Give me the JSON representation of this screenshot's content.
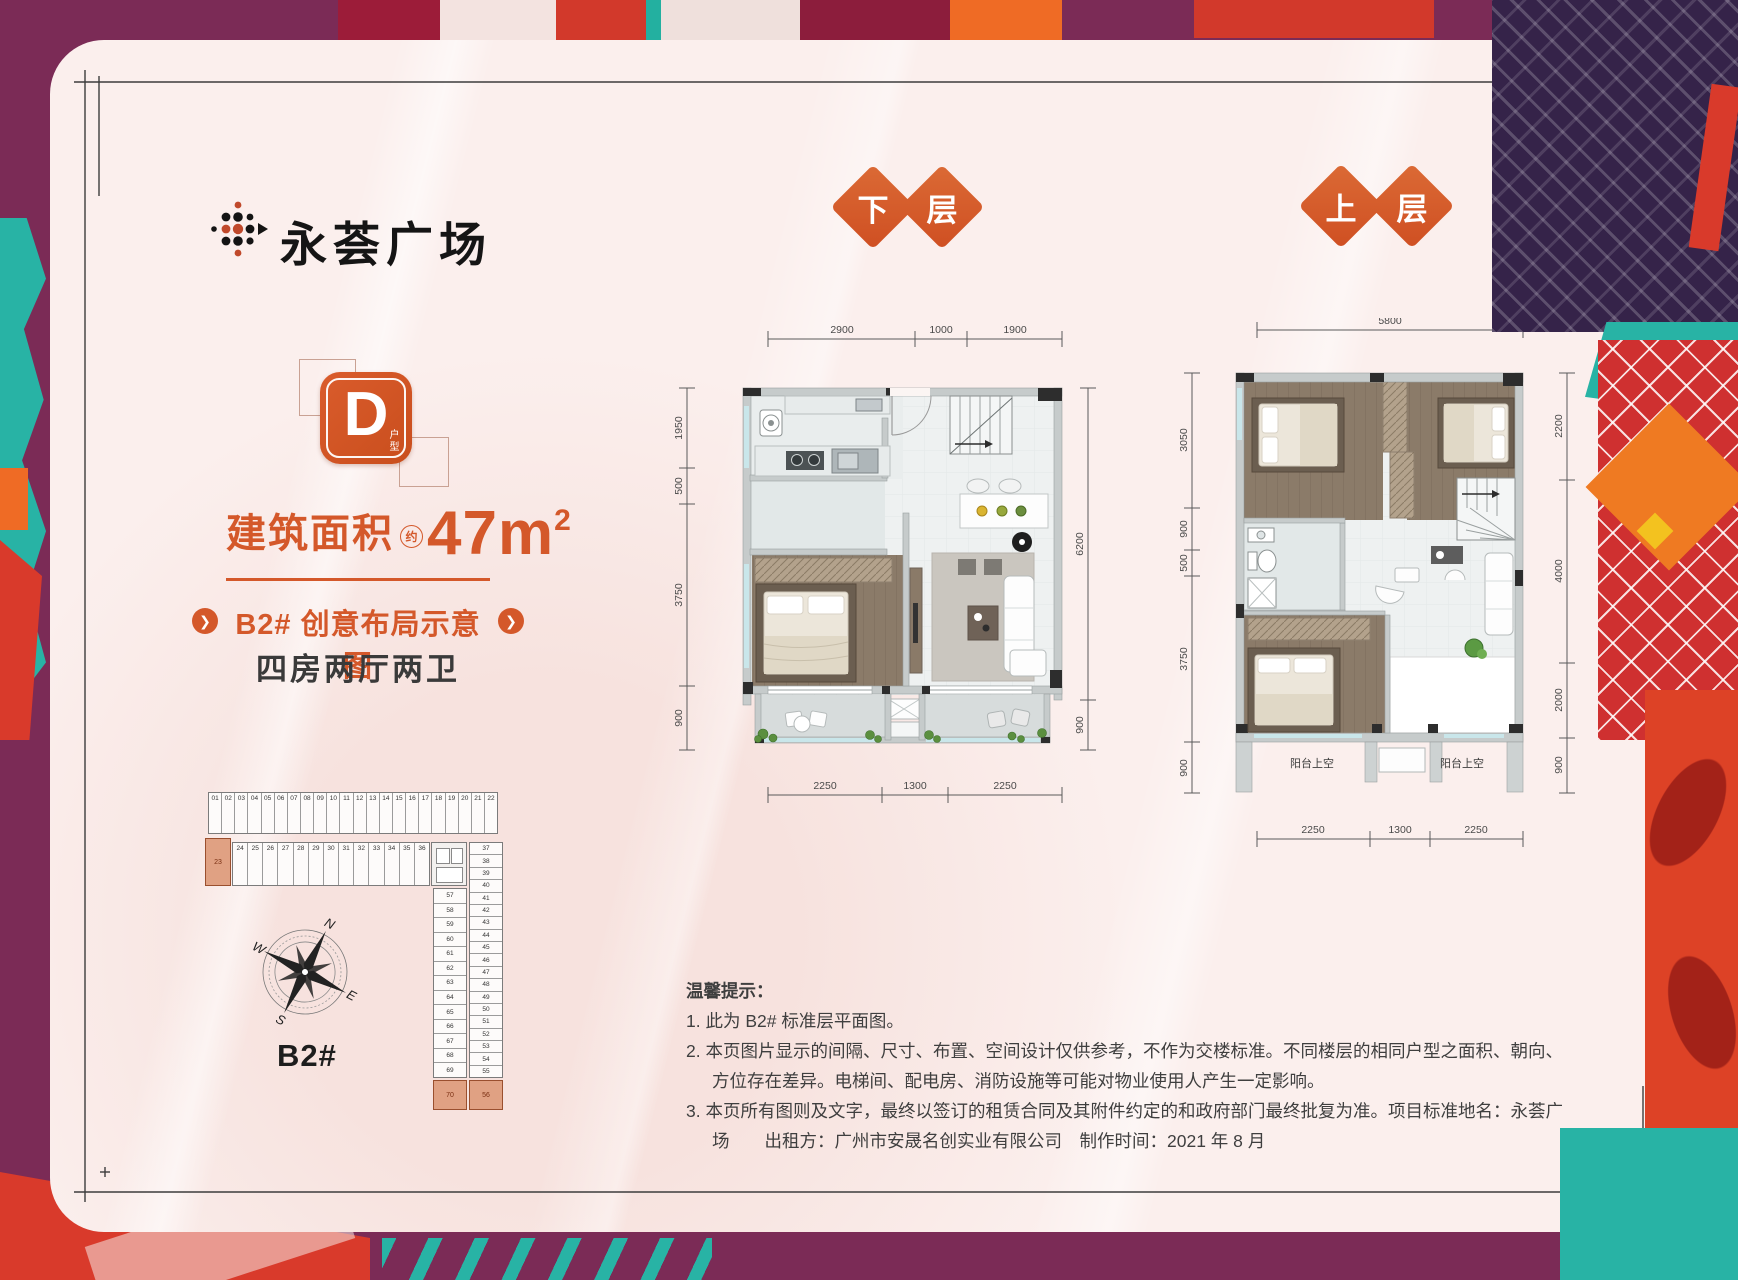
{
  "logo": {
    "name": "永荟广场"
  },
  "unit_badge": {
    "letter": "D",
    "suffix": "户型"
  },
  "area": {
    "prefix": "建筑面积",
    "approx": "约",
    "value": "47m",
    "sup": "2"
  },
  "subtitle": "B2# 创意布局示意图",
  "layout_desc": "四房两厅两卫",
  "colors": {
    "accent": "#d4582a",
    "card": "#fbefed",
    "plum": "#7b2b56",
    "teal": "#28b3a5",
    "red": "#d93a2b",
    "orange": "#ef6b25",
    "purple": "#352349",
    "highlight_unit": "#e0a183"
  },
  "plans": {
    "lower": {
      "label_chars": [
        "下",
        "层"
      ],
      "dims_top": [
        "2900",
        "1000",
        "1900"
      ],
      "dims_left": [
        "1950",
        "500",
        "3750",
        "900"
      ],
      "dims_right": [
        "6200",
        "900"
      ],
      "dims_bottom": [
        "2250",
        "1300",
        "2250"
      ]
    },
    "upper": {
      "label_chars": [
        "上",
        "层"
      ],
      "dims_top": [
        "5800"
      ],
      "dims_left": [
        "3050",
        "900",
        "500",
        "3750",
        "900"
      ],
      "dims_right": [
        "2200",
        "4000",
        "2000",
        "900"
      ],
      "dims_bottom": [
        "2250",
        "1300",
        "2250"
      ],
      "void_labels": [
        "阳台上空",
        "阳台上空"
      ]
    }
  },
  "siteplan": {
    "label": "B2#",
    "compass": [
      "N",
      "W",
      "S",
      "E"
    ],
    "row1": [
      "01",
      "02",
      "03",
      "04",
      "05",
      "06",
      "07",
      "08",
      "09",
      "10",
      "11",
      "12",
      "13",
      "14",
      "15",
      "16",
      "17",
      "18",
      "19",
      "20",
      "21",
      "22"
    ],
    "row2": [
      "24",
      "25",
      "26",
      "27",
      "28",
      "29",
      "30",
      "31",
      "32",
      "33",
      "34",
      "35",
      "36"
    ],
    "colA": [
      "57",
      "58",
      "59",
      "60",
      "61",
      "62",
      "63",
      "64",
      "65",
      "66",
      "67",
      "68",
      "69"
    ],
    "colB": [
      "37",
      "38",
      "39",
      "40",
      "41",
      "42",
      "43",
      "44",
      "45",
      "46",
      "47",
      "48",
      "49",
      "50",
      "51",
      "52",
      "53",
      "54",
      "55"
    ],
    "highlights": [
      "23",
      "70",
      "56"
    ]
  },
  "notes": {
    "title": "温馨提示：",
    "items": [
      "1. 此为 B2# 标准层平面图。",
      "2. 本页图片显示的间隔、尺寸、布置、空间设计仅供参考，不作为交楼标准。不同楼层的相同户型之面积、朝向、方位存在差异。电梯间、配电房、消防设施等可能对物业使用人产生一定影响。",
      "3. 本页所有图则及文字，最终以签订的租赁合同及其附件约定的和政府部门最终批复为准。项目标准地名：永荟广场　　出租方：广州市安晟名创实业有限公司　制作时间：2021 年 8 月"
    ]
  }
}
